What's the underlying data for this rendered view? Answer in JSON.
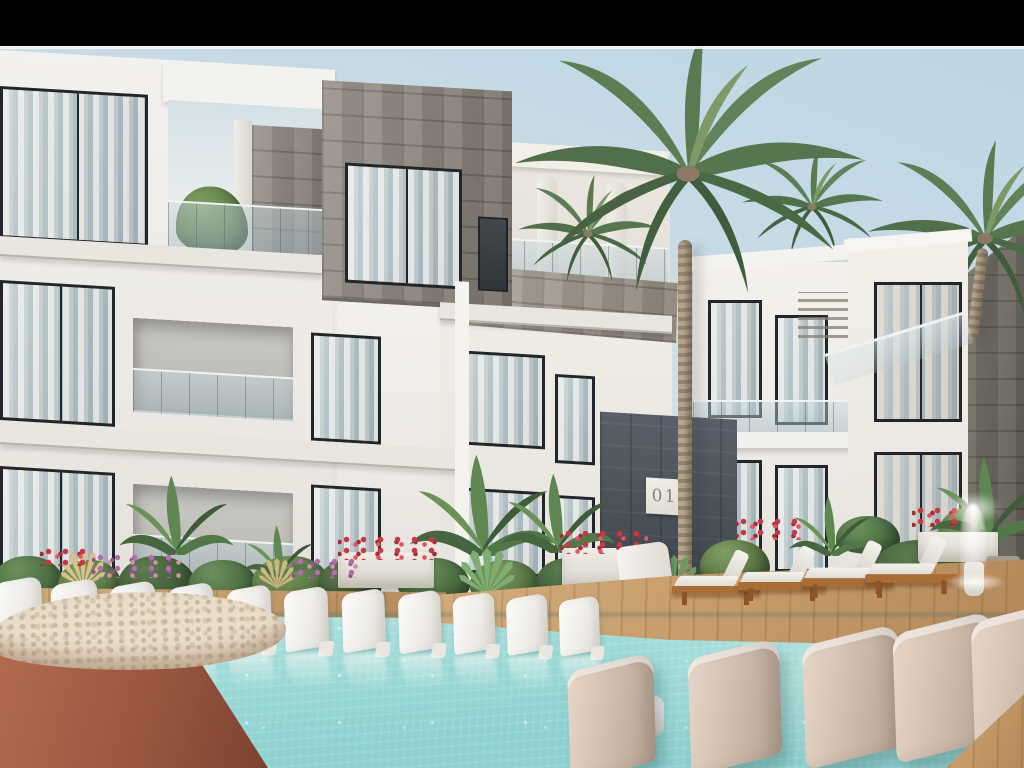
{
  "sign": {
    "unit_number": "01"
  },
  "scene_type": "architectural exterior render of a resort apartment complex with swimming pool",
  "palette": {
    "letterbox": "#020202",
    "sky_top": "#bdd6e3",
    "sky_horizon": "#ecf0ee",
    "facade_white": "#f1eeea",
    "stone_masonry": "#8f887e",
    "stone_dark": "#6b675e",
    "slate_accent_wall": "#49525b",
    "window_frame": "#22262a",
    "window_glass": "#a9bcc4",
    "curtain_white": "#f0efeb",
    "pool_water": "#97d7d4",
    "deck_wood": "#c59a69",
    "lounger_white": "#f4f2ee",
    "lounger_beige": "#cfbcad",
    "lounger_wood_frame": "#a96d38",
    "terracotta_planter": "#a05a41",
    "planter_top": "#e9ddcc",
    "palm_green": "#55754d",
    "flower_red": "#c8393f",
    "flower_pink": "#b06fae"
  }
}
